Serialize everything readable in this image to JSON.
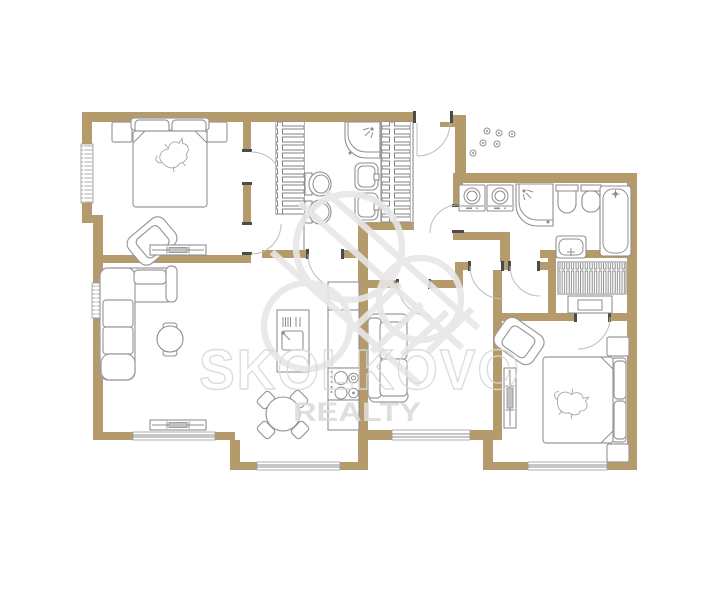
{
  "watermark": {
    "brand": "SKOLKOVO",
    "tagline": "REALTY"
  },
  "palette": {
    "background": "#ffffff",
    "wall": "#b59a6b",
    "fixture_line": "#8f8f8f",
    "door_arc": "#bdbdbd",
    "door_jamb": "#4b4b4b",
    "watermark_outline": "#d9d9d9",
    "watermark_fill": "#dcdcdc"
  },
  "floor_plan": {
    "type": "apartment-floor-plan",
    "rooms": [
      {
        "name": "bedroom-1",
        "furniture": [
          "double-bed",
          "pillows",
          "nightstand",
          "nightstand",
          "armchair",
          "radiator",
          "window"
        ]
      },
      {
        "name": "walk-in-closet",
        "furniture": [
          "shelf-unit"
        ]
      },
      {
        "name": "bathroom-1",
        "furniture": [
          "corner-shower",
          "sink",
          "sink",
          "toilet",
          "toilet",
          "shelf-unit"
        ]
      },
      {
        "name": "entry-hall",
        "furniture": [
          "entrance-door",
          "coat-hooks"
        ]
      },
      {
        "name": "bathroom-2",
        "furniture": [
          "washing-machine",
          "dryer",
          "corner-shower",
          "toilet",
          "bidet",
          "bathtub",
          "vanity-sink"
        ]
      },
      {
        "name": "living-room",
        "furniture": [
          "corner-sofa",
          "coffee-table",
          "radiator",
          "window",
          "window"
        ]
      },
      {
        "name": "kitchen-dining",
        "furniture": [
          "island-with-sink",
          "cooktop",
          "tall-cabinets",
          "dining-table",
          "chair",
          "chair",
          "chair",
          "chair",
          "window"
        ]
      },
      {
        "name": "study",
        "furniture": [
          "sofa",
          "window"
        ]
      },
      {
        "name": "bedroom-2",
        "furniture": [
          "double-bed",
          "nightstand",
          "nightstand",
          "wardrobe-rail",
          "shelf",
          "armchair",
          "vertical-radiator",
          "window"
        ]
      }
    ]
  }
}
